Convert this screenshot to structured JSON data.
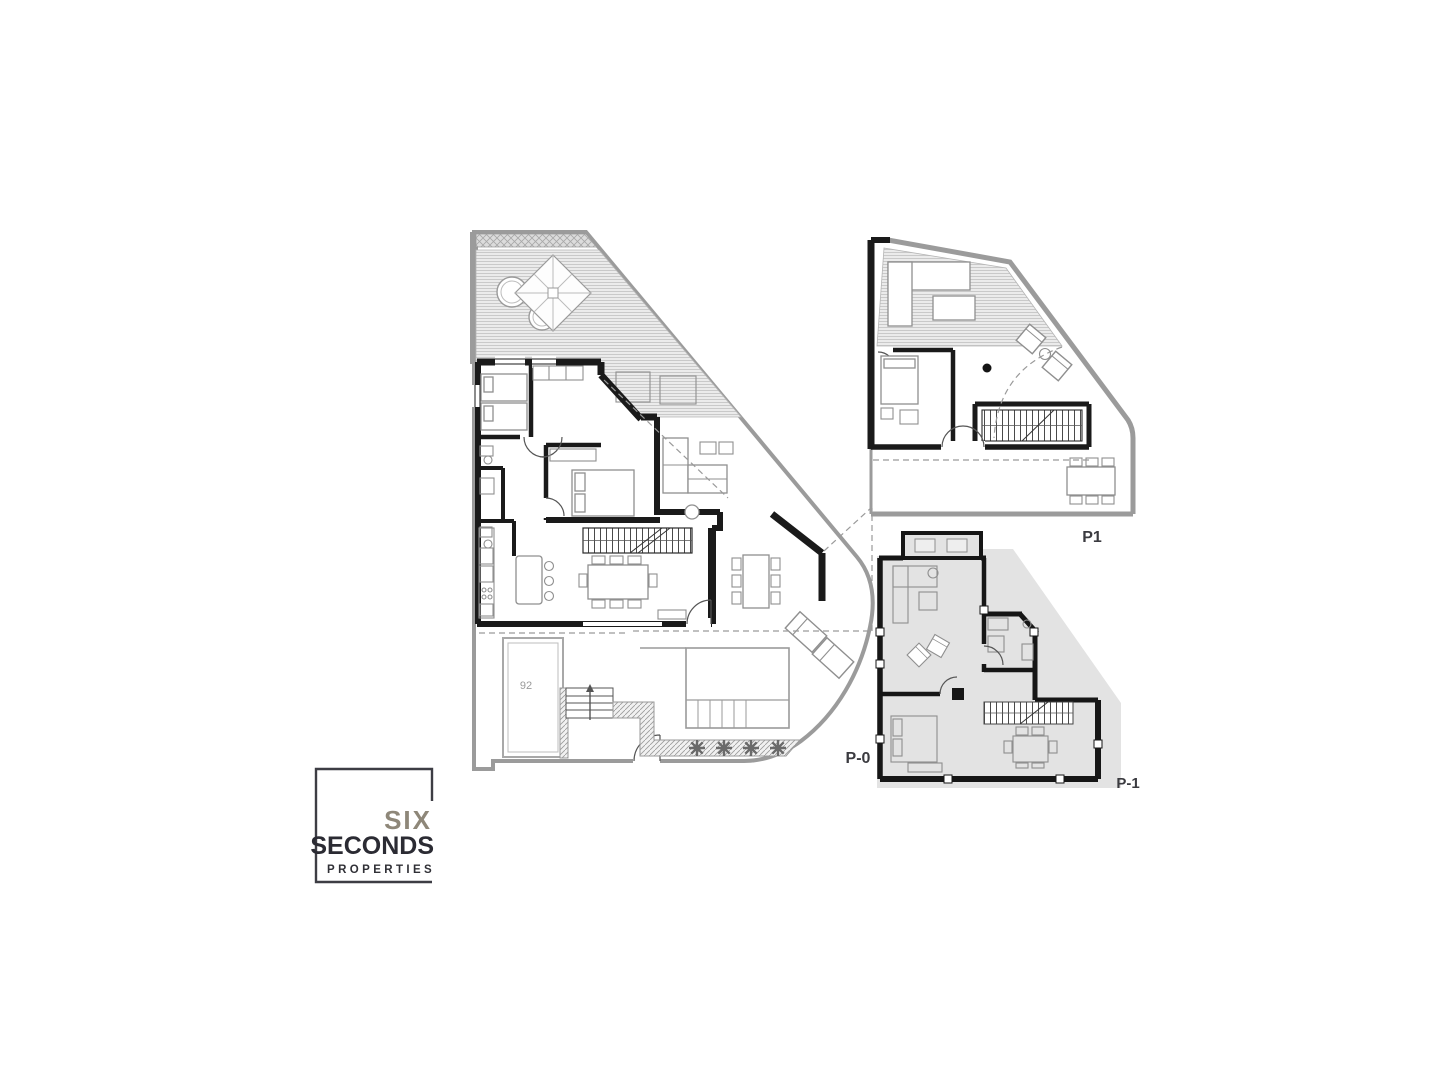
{
  "page": {
    "background": "#ffffff",
    "type": "architectural floor plans sheet"
  },
  "plans": {
    "p0": {
      "label": "P-0",
      "pool_label": "92"
    },
    "p1": {
      "label": "P1"
    },
    "pm1": {
      "label": "P-1"
    }
  },
  "logo": {
    "line1": "SIX",
    "line2": "SECONDS",
    "line3": "PROPERTIES"
  },
  "colors": {
    "wall": "#1a1a1a",
    "plot_boundary": "#9b9b9b",
    "terrace_fill": "#ebebeb",
    "terrace_hatch_line": "#c9c9c9",
    "basement_fill": "#e3e3e3",
    "furniture_line": "#8f8f8f",
    "label_text": "#3b3b40",
    "logo_accent": "#8e8779",
    "logo_dark": "#2b2b33"
  }
}
